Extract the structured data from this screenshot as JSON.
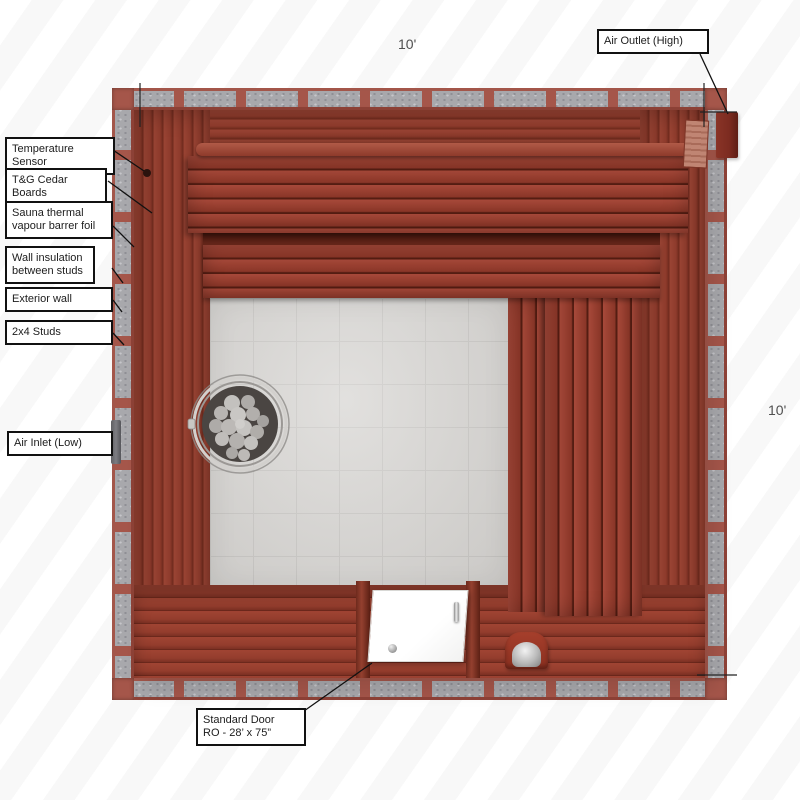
{
  "diagram": {
    "dimension_top": "10'",
    "dimension_right": "10'",
    "callouts_left": [
      {
        "text": "Temperature Sensor"
      },
      {
        "text": "T&G Cedar Boards"
      },
      {
        "text": "Sauna thermal vapour barrer foil"
      },
      {
        "text": "Wall insulation between studs"
      },
      {
        "text": "Exterior wall"
      },
      {
        "text": "2x4 Studs"
      },
      {
        "text": "Air Inlet (Low)"
      }
    ],
    "callout_air_outlet": "Air Outlet (High)",
    "callout_door": {
      "line1": "Standard Door",
      "line2": "RO - 28’ x 75”"
    },
    "colors": {
      "cedar_wood": "#9a4434",
      "wood_gap_dark": "#541d12",
      "insulation_gray": "#a8a8ac",
      "stud_red": "#a5564a",
      "tile_floor": "#d5d3d0",
      "door_white": "#ffffff",
      "vent_dark": "#7c2b20",
      "label_border": "#111111",
      "dimension_text": "#4f4f4f"
    }
  }
}
